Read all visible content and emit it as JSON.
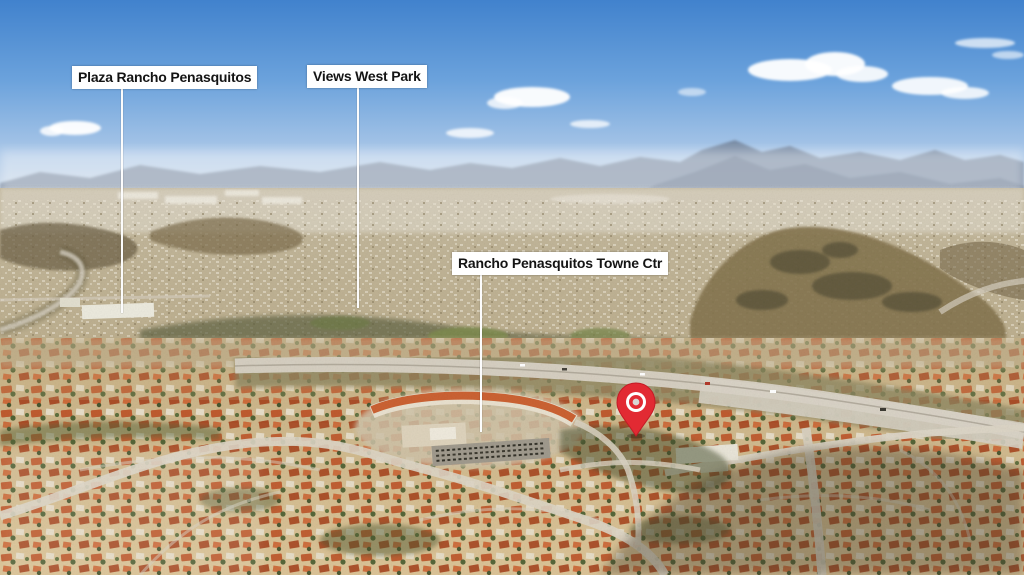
{
  "scene": {
    "description": "Aerial drone photograph of a suburban neighborhood (Rancho Penasquitos) with blue sky, distant mountains and dense terracotta-roofed housing tracts, annotated with landmark callouts and a red location pin"
  },
  "labels": {
    "plaza": "Plaza Rancho Penasquitos",
    "views_west_park": "Views West Park",
    "towne_ctr": "Rancho Penasquitos Towne Ctr"
  },
  "pin": {
    "name": "location-pin",
    "color": "#e22a33"
  },
  "colors": {
    "sky_top": "#4688d3",
    "sky_horizon": "#d3dde8",
    "mountain_haze": "#74859c",
    "valley_tan": "#bfb293",
    "suburb_tan": "#d2bb8e",
    "roof_orange": "#bf5a2e",
    "tree_green": "#4f6134",
    "road_gray": "#ddd5c5",
    "label_bg": "#ffffff",
    "label_text": "#141414",
    "leader_line": "#fcfcfc",
    "pin_red": "#e22a33"
  }
}
